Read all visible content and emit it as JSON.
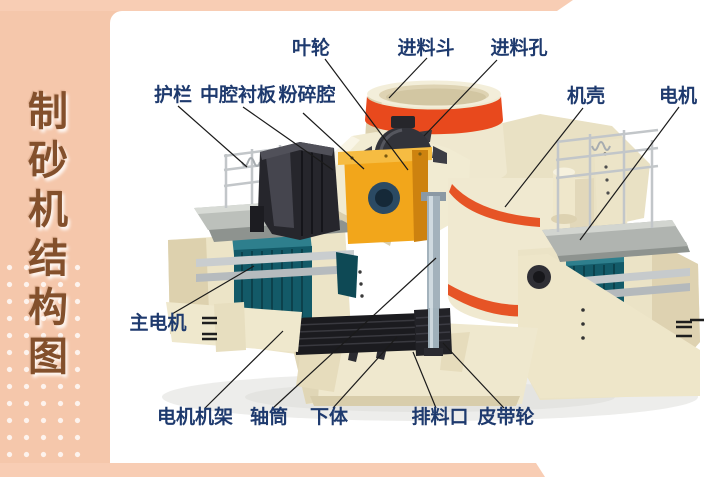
{
  "sidebar": {
    "title": "制砂机结构图",
    "title_chars": [
      "制",
      "砂",
      "机",
      "结",
      "构",
      "图"
    ]
  },
  "diagram": {
    "labels": {
      "yelun": "叶轮",
      "jinliaodou": "进料斗",
      "jinliaokong": "进料孔",
      "hulan": "护栏",
      "zhongqiang": "中腔衬板",
      "fensui": "粉碎腔",
      "jike": "机壳",
      "dianji": "电机",
      "zhudianji": "主电机",
      "jijia": "电机机架",
      "zhoutong": "轴筒",
      "xiati": "下体",
      "pailiaokou": "排料口",
      "pidailun": "皮带轮"
    }
  },
  "colors": {
    "sidebar_bg": "#f5c7ab",
    "accent_bar_bg": "#f8cdb4",
    "panel_bg": "#ffffff",
    "title_text": "#83502c",
    "label_text": "#1e3a6e",
    "leader_line": "#1a1a1a",
    "machine_cream": "#f0e9d0",
    "machine_red": "#e8491d",
    "machine_orange_stripe": "#e65426",
    "machine_yellow": "#f2a61b",
    "machine_teal": "#135a68",
    "machine_dark": "#26262c",
    "metal_gray": "#c2c6c9",
    "shaft_gray": "#a3b2bc"
  }
}
